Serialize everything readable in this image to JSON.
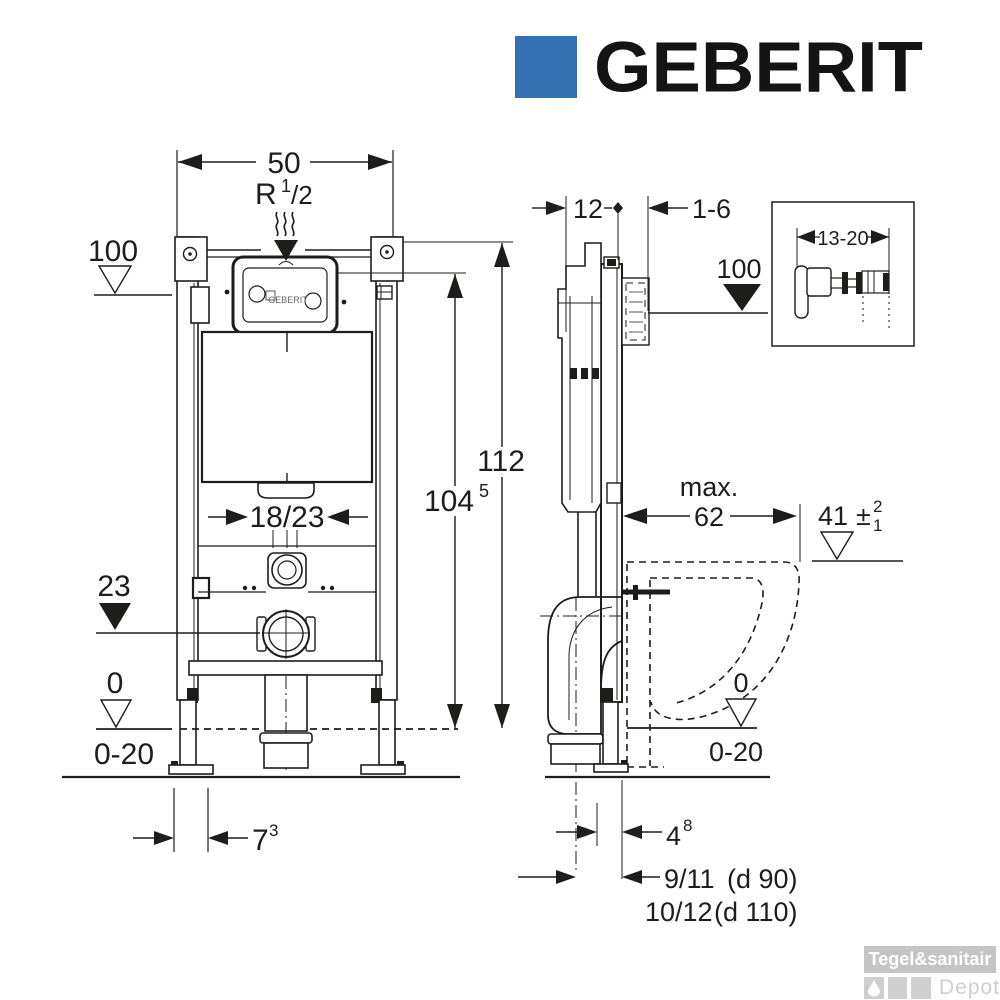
{
  "logo": {
    "brand": "GEBERIT",
    "square_color": "#3470b4"
  },
  "front_view": {
    "width_dim": "50",
    "supply_thread_base": "R",
    "supply_thread_num": "1",
    "supply_thread_den": "/2",
    "supply_datum": "100",
    "overall_height_dim": "112",
    "actuator_height_base": "104",
    "actuator_height_sup": "5",
    "flush_pipe_dim": "18/23",
    "outlet_datum": "23",
    "floor_datum": "0",
    "floor_adjust_range": "0-20",
    "leg_offset_base": "7",
    "leg_offset_sup": "3",
    "window_brand": "GEBERIT"
  },
  "side_view": {
    "frame_depth_dim": "12",
    "wall_gap_dim": "1-6",
    "supply_datum": "100",
    "max_label": "max.",
    "max_depth_dim": "62",
    "bowl_height_base": "41",
    "bowl_height_pm": "±",
    "bowl_tol_plus": "2",
    "bowl_tol_minus": "1",
    "floor_datum": "0",
    "floor_adjust_range": "0-20",
    "outlet_offset_base": "4",
    "outlet_offset_sup": "8",
    "drain_offset_1": "9/11",
    "drain_dia_1": "(d 90)",
    "drain_offset_2": "10/12",
    "drain_dia_2": "(d 110)",
    "inset_dim": "13-20"
  },
  "watermark": {
    "line1": "Tegel&sanitair",
    "line2": "Depot"
  }
}
